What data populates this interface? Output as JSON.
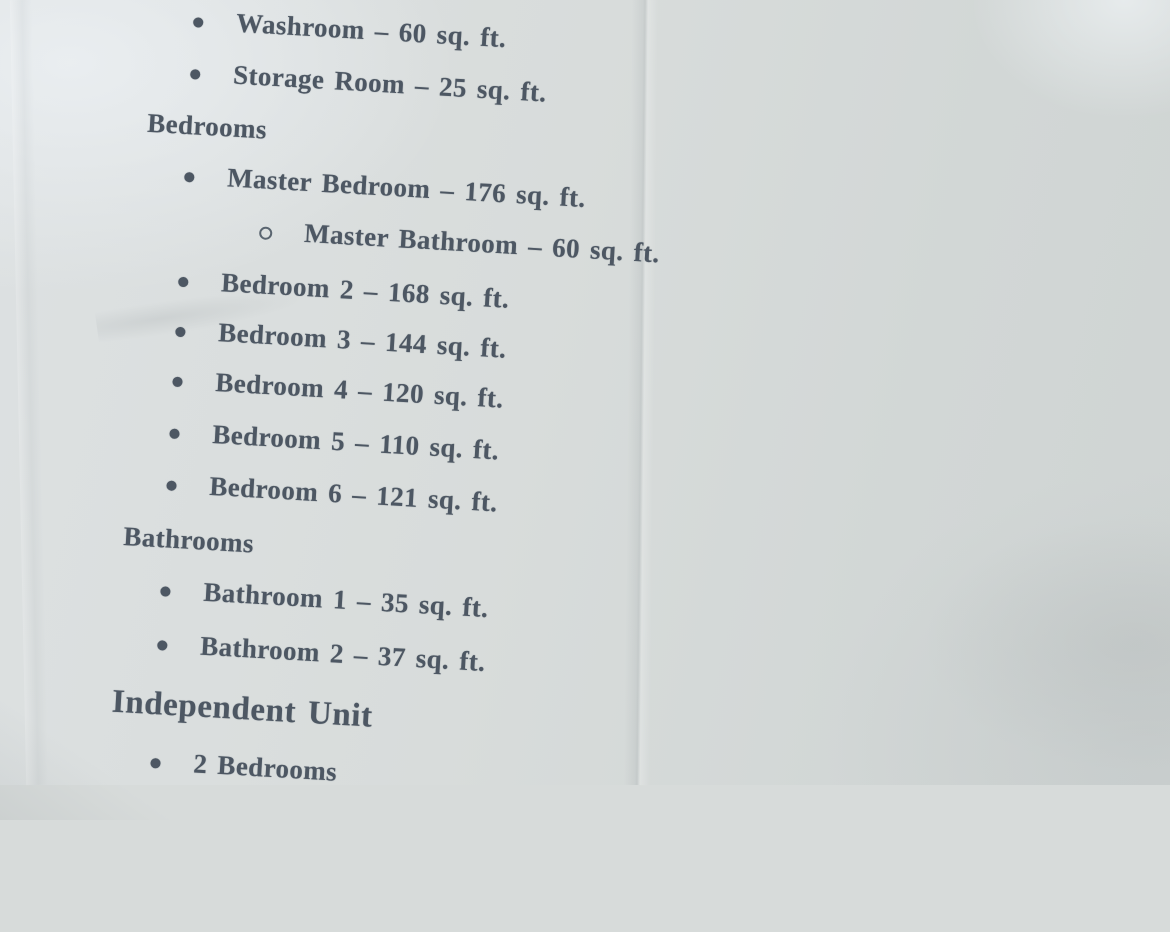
{
  "paper": {
    "background_color": "#d7dbda",
    "text_color": "#4d5763",
    "description": "Photograph of a printed real-estate room list on creased paper"
  },
  "content": {
    "items": [
      {
        "style": "bullet",
        "level": 1,
        "text": "Washroom – 60 sq. ft."
      },
      {
        "style": "bullet",
        "level": 1,
        "text": "Storage Room – 25 sq. ft."
      },
      {
        "style": "heading",
        "level": 1,
        "text": "Bedrooms"
      },
      {
        "style": "bullet",
        "level": 1,
        "text": "Master Bedroom – 176 sq. ft."
      },
      {
        "style": "bullet",
        "level": 2,
        "text": "Master Bathroom – 60 sq. ft."
      },
      {
        "style": "bullet",
        "level": 1,
        "text": "Bedroom 2 – 168 sq. ft."
      },
      {
        "style": "bullet",
        "level": 1,
        "text": "Bedroom 3 – 144 sq. ft."
      },
      {
        "style": "bullet",
        "level": 1,
        "text": "Bedroom 4 – 120 sq. ft."
      },
      {
        "style": "bullet",
        "level": 1,
        "text": "Bedroom 5 – 110 sq. ft."
      },
      {
        "style": "bullet",
        "level": 1,
        "text": "Bedroom 6 – 121 sq. ft."
      },
      {
        "style": "heading",
        "level": 1,
        "text": "Bathrooms"
      },
      {
        "style": "bullet",
        "level": 1,
        "text": "Bathroom 1 – 35 sq. ft."
      },
      {
        "style": "bullet",
        "level": 1,
        "text": "Bathroom 2 – 37 sq. ft."
      },
      {
        "style": "heading",
        "level": 0,
        "text": "Independent Unit"
      },
      {
        "style": "bullet",
        "level": 1,
        "text": "2 Bedrooms"
      }
    ]
  }
}
